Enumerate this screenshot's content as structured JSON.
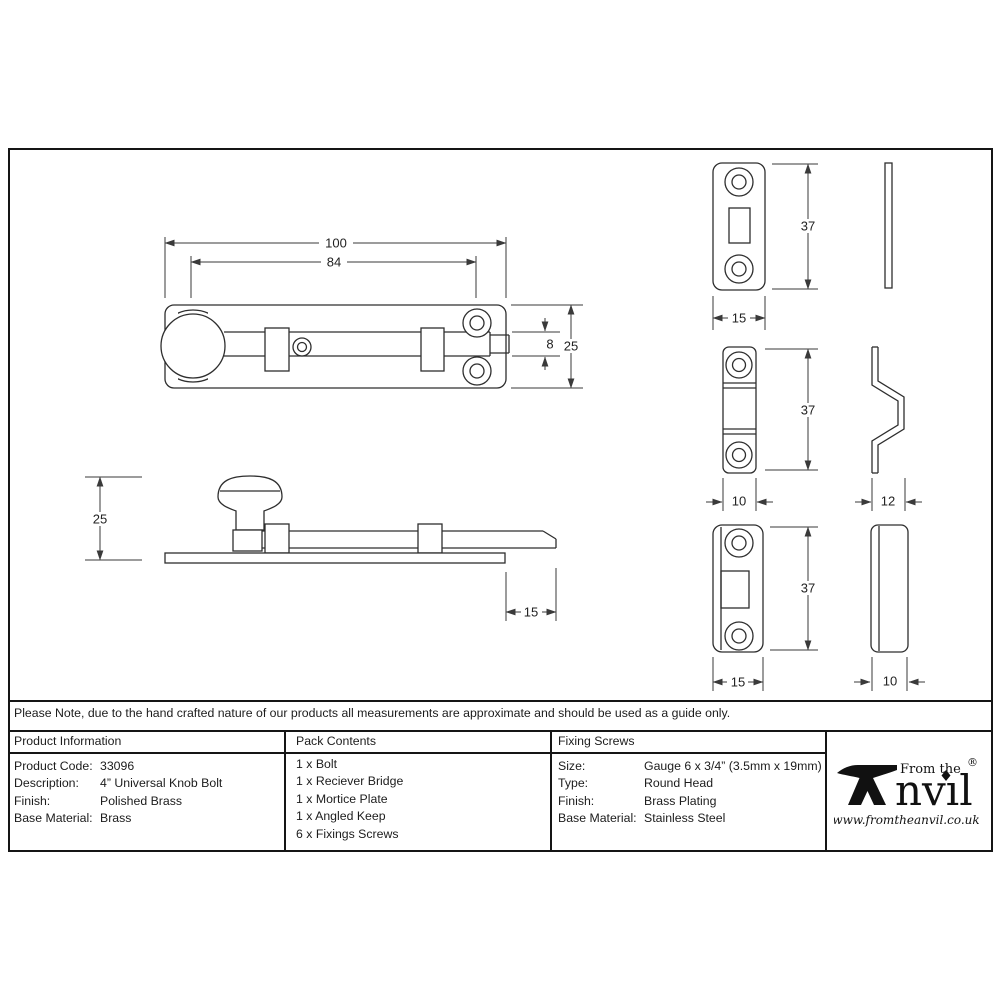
{
  "note": "Please Note, due to the hand crafted nature of our products all measurements are approximate and should be used as a guide only.",
  "table": {
    "product_information": {
      "header": "Product Information",
      "rows": [
        {
          "label": "Product Code:",
          "value": "33096"
        },
        {
          "label": "Description:",
          "value": "4” Universal Knob Bolt"
        },
        {
          "label": "Finish:",
          "value": "Polished Brass"
        },
        {
          "label": "Base Material:",
          "value": "Brass"
        }
      ]
    },
    "pack_contents": {
      "header": "Pack Contents",
      "items": [
        "1 x Bolt",
        "1 x Reciever Bridge",
        "1 x Mortice Plate",
        "1 x Angled Keep",
        "6 x Fixings Screws"
      ]
    },
    "fixing_screws": {
      "header": "Fixing Screws",
      "rows": [
        {
          "label": "Size:",
          "value": "Gauge 6 x 3/4” (3.5mm x 19mm)"
        },
        {
          "label": "Type:",
          "value": "Round Head"
        },
        {
          "label": "Finish:",
          "value": "Brass Plating"
        },
        {
          "label": "Base Material:",
          "value": "Stainless Steel"
        }
      ]
    }
  },
  "logo": {
    "top": "From the",
    "name_rest": "nvıl",
    "registered": "®",
    "website": "www.fromtheanvil.co.uk"
  },
  "dims": {
    "top_overall": "100",
    "top_centres": "84",
    "top_bolt_width": "8",
    "top_plate_width": "25",
    "side_height": "25",
    "side_throw": "15",
    "mortice_height": "37",
    "mortice_width": "15",
    "bridge_height": "37",
    "bridge_width": "10",
    "bridge_depth": "12",
    "keep_height": "37",
    "keep_width": "15",
    "keep_depth": "10"
  },
  "colors": {
    "line": "#2e2e2e",
    "border": "#151515",
    "background": "#ffffff"
  }
}
